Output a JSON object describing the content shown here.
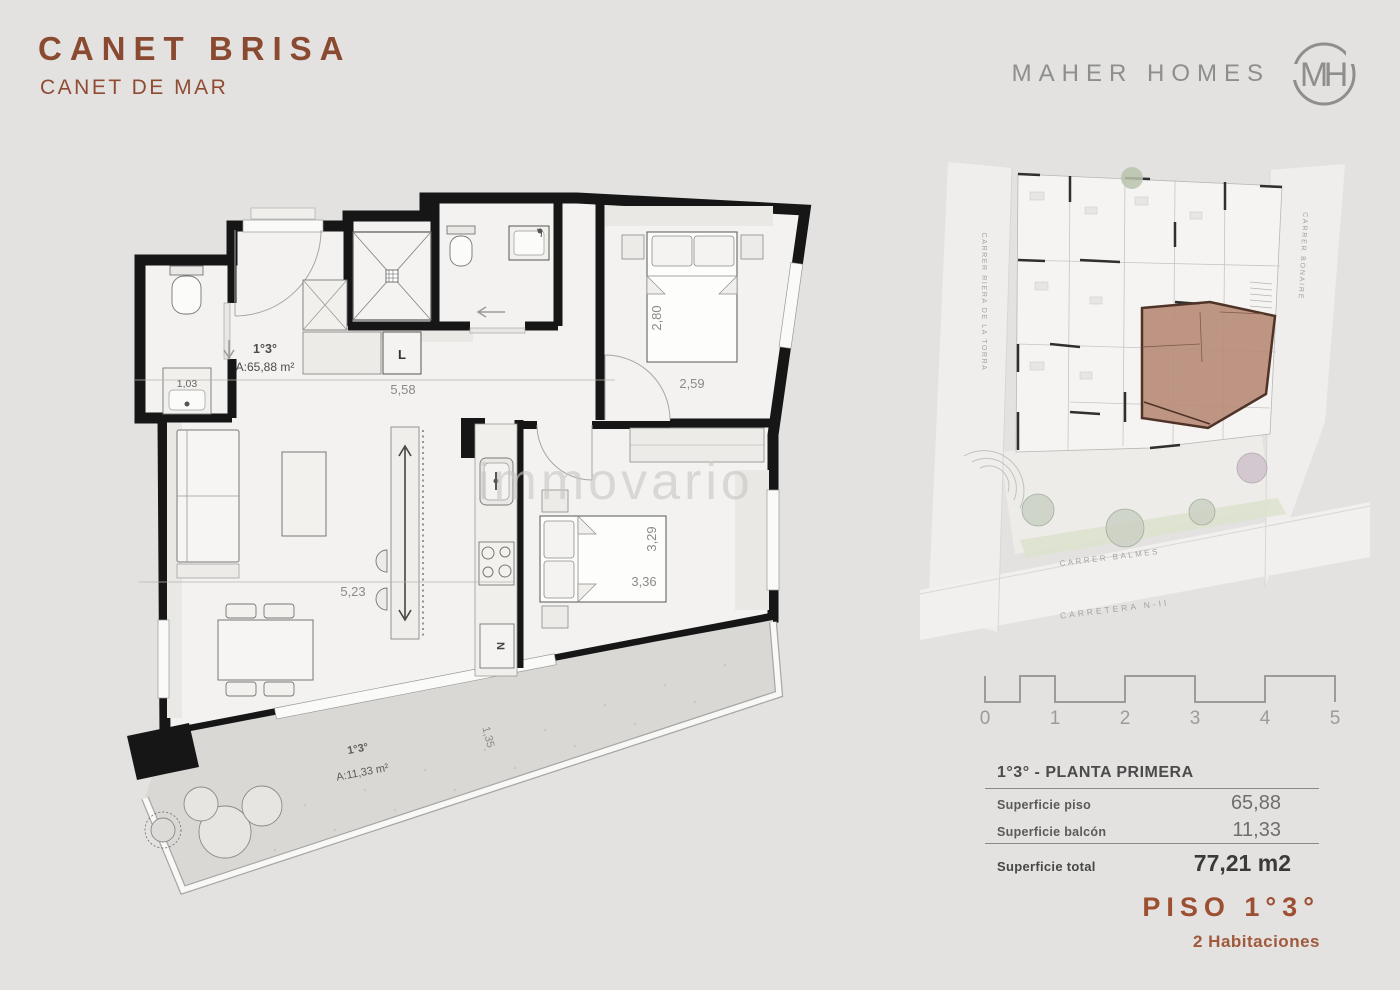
{
  "page": {
    "background_color": "#e3e2e0",
    "accent_color": "#8a4a31"
  },
  "header": {
    "title": "CANET BRISA",
    "subtitle": "CANET DE MAR",
    "brand_name": "MAHER HOMES",
    "logo_monogram_m": "M",
    "logo_monogram_h": "H"
  },
  "floor_plan": {
    "watermark": "immovario",
    "apartment": {
      "unit": "1°3°",
      "area": "A:65,88 m²"
    },
    "balcony": {
      "unit": "1°3°",
      "area": "A:11,33 m²"
    },
    "labels": {
      "closet": "L",
      "appliance": "N",
      "sink": "1,03"
    },
    "dimensions": {
      "hall_width": "5,58",
      "living_width": "5,23",
      "bedroom1_depth": "2,80",
      "bedroom1_width": "2,59",
      "bedroom2_depth": "3,29",
      "bedroom2_width": "3,36",
      "balcony_depth": "1,35"
    }
  },
  "site_plan": {
    "street_left": "CARRER RIERA DE LA TORRA",
    "street_right": "CARRER BONAIRE",
    "street_bottom": "CARRER BALMES",
    "road_bottom": "CARRETERA N-II",
    "highlight_color": "#b98c7a"
  },
  "scale_bar": {
    "labels": [
      "0",
      "1",
      "2",
      "3",
      "4",
      "5"
    ]
  },
  "summary_table": {
    "title": "1°3° - PLANTA PRIMERA",
    "rows": [
      {
        "label": "Superficie piso",
        "value": "65,88"
      },
      {
        "label": "Superficie balcón",
        "value": "11,33"
      }
    ],
    "total_label": "Superficie total",
    "total_value": "77,21 m2"
  },
  "footer": {
    "floor": "PISO 1°3°",
    "rooms": "2 Habitaciones"
  }
}
